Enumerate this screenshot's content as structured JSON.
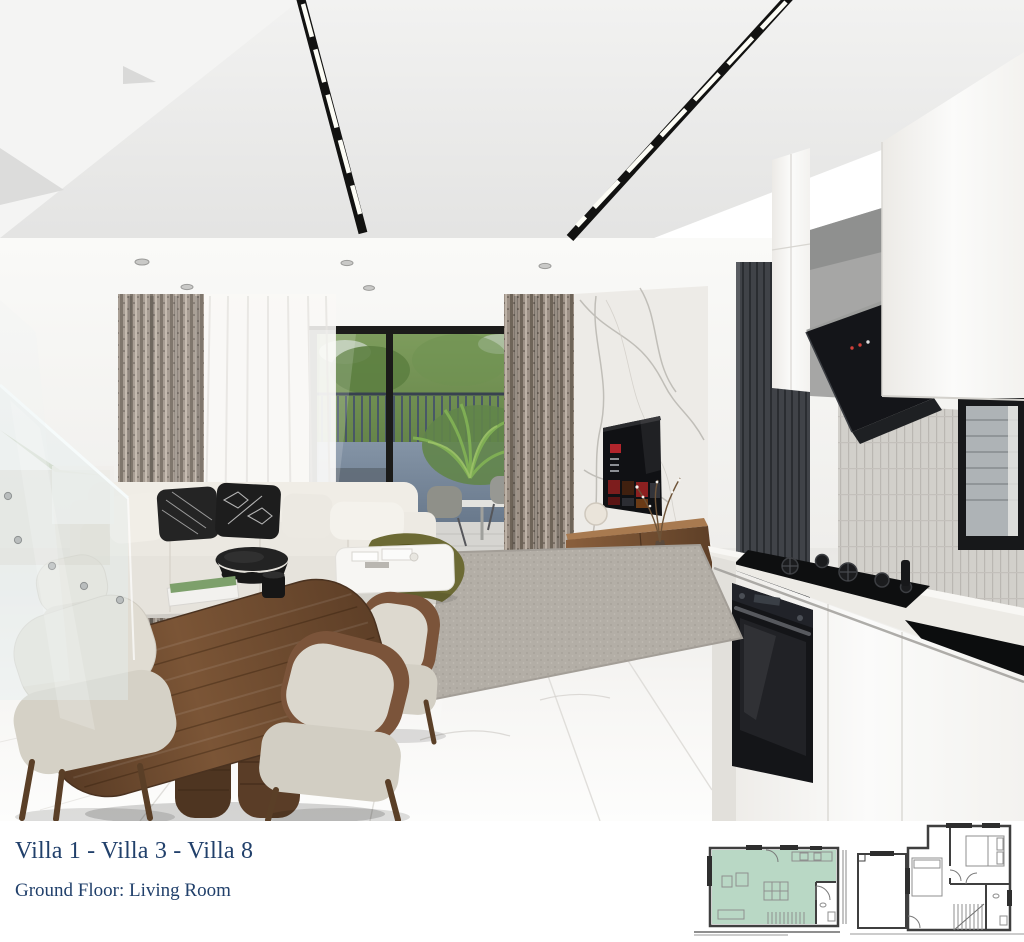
{
  "caption": {
    "title": "Villa 1 - Villa 3 - Villa 8",
    "subtitle": "Ground Floor: Living Room",
    "text_color": "#21406b"
  },
  "floor_plans": {
    "ground": {
      "label": "ground-floor-plan",
      "highlighted_room": "Living Room",
      "highlight_color": "#b9d8c5"
    },
    "upper": {
      "label": "upper-floor-plan"
    }
  },
  "render": {
    "label": "open-plan-living-room-dining-kitchen-render",
    "colors": {
      "ceiling": "#ededec",
      "wall": "#f5f4f1",
      "floor": "#f2f1ee",
      "marble_wall": "#edebe7",
      "curtain": "#9a8d81",
      "sheer": "#f7f6f4",
      "window_frame": "#1c1c1a",
      "greenery": "#6a8f4d",
      "outdoor_wall": "#8494a6",
      "sofa": "#efece5",
      "pillow_dark": "#1f1f1f",
      "rug": "#b5b0a8",
      "table_wood": "#6b4a31",
      "console_wood": "#815a39",
      "tv_screen": "#101114",
      "tv_red": "#b1252c",
      "cabinet": "#f6f5f2",
      "hood_black": "#141519",
      "backsplash": "#d2d0cb",
      "counter": "#edebe6",
      "dark_panel": "#3e4146",
      "appliance_black": "#16171a"
    }
  }
}
